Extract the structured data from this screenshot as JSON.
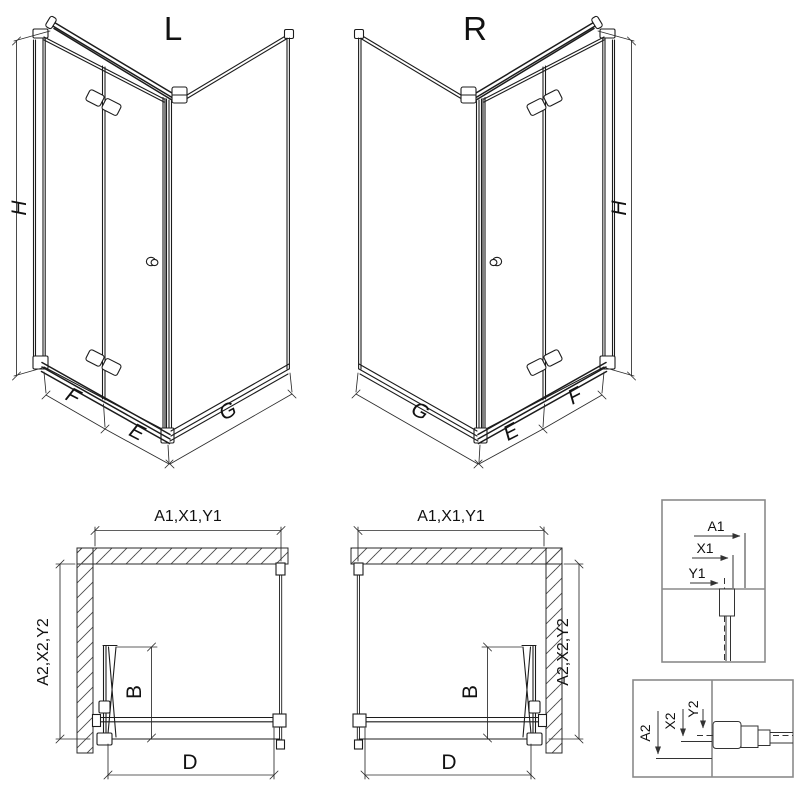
{
  "views": {
    "iso_left": {
      "title": "L",
      "dim_height": "H",
      "dim_front_hinge_section": "F",
      "dim_front_handle_section": "E",
      "dim_side": "G"
    },
    "iso_right": {
      "title": "R",
      "dim_height": "H",
      "dim_front_hinge_section": "F",
      "dim_front_handle_section": "E",
      "dim_side": "G"
    },
    "plan_left": {
      "dim_width": "A1,X1,Y1",
      "dim_depth": "A2,X2,Y2",
      "dim_door_projection": "B",
      "dim_entry": "D"
    },
    "plan_right": {
      "dim_width": "A1,X1,Y1",
      "dim_depth": "A2,X2,Y2",
      "dim_door_projection": "B",
      "dim_entry": "D"
    },
    "detail_wall_profile": {
      "labels": [
        "A1",
        "X1",
        "Y1"
      ]
    },
    "detail_floor_profile": {
      "labels": [
        "A2",
        "X2",
        "Y2"
      ]
    }
  },
  "colors": {
    "line": "#1c1c1c",
    "dim_line": "#2b2b2b",
    "detail_frame": "#8a8a8a",
    "hatch": "#4a4a4a",
    "background": "#ffffff"
  }
}
